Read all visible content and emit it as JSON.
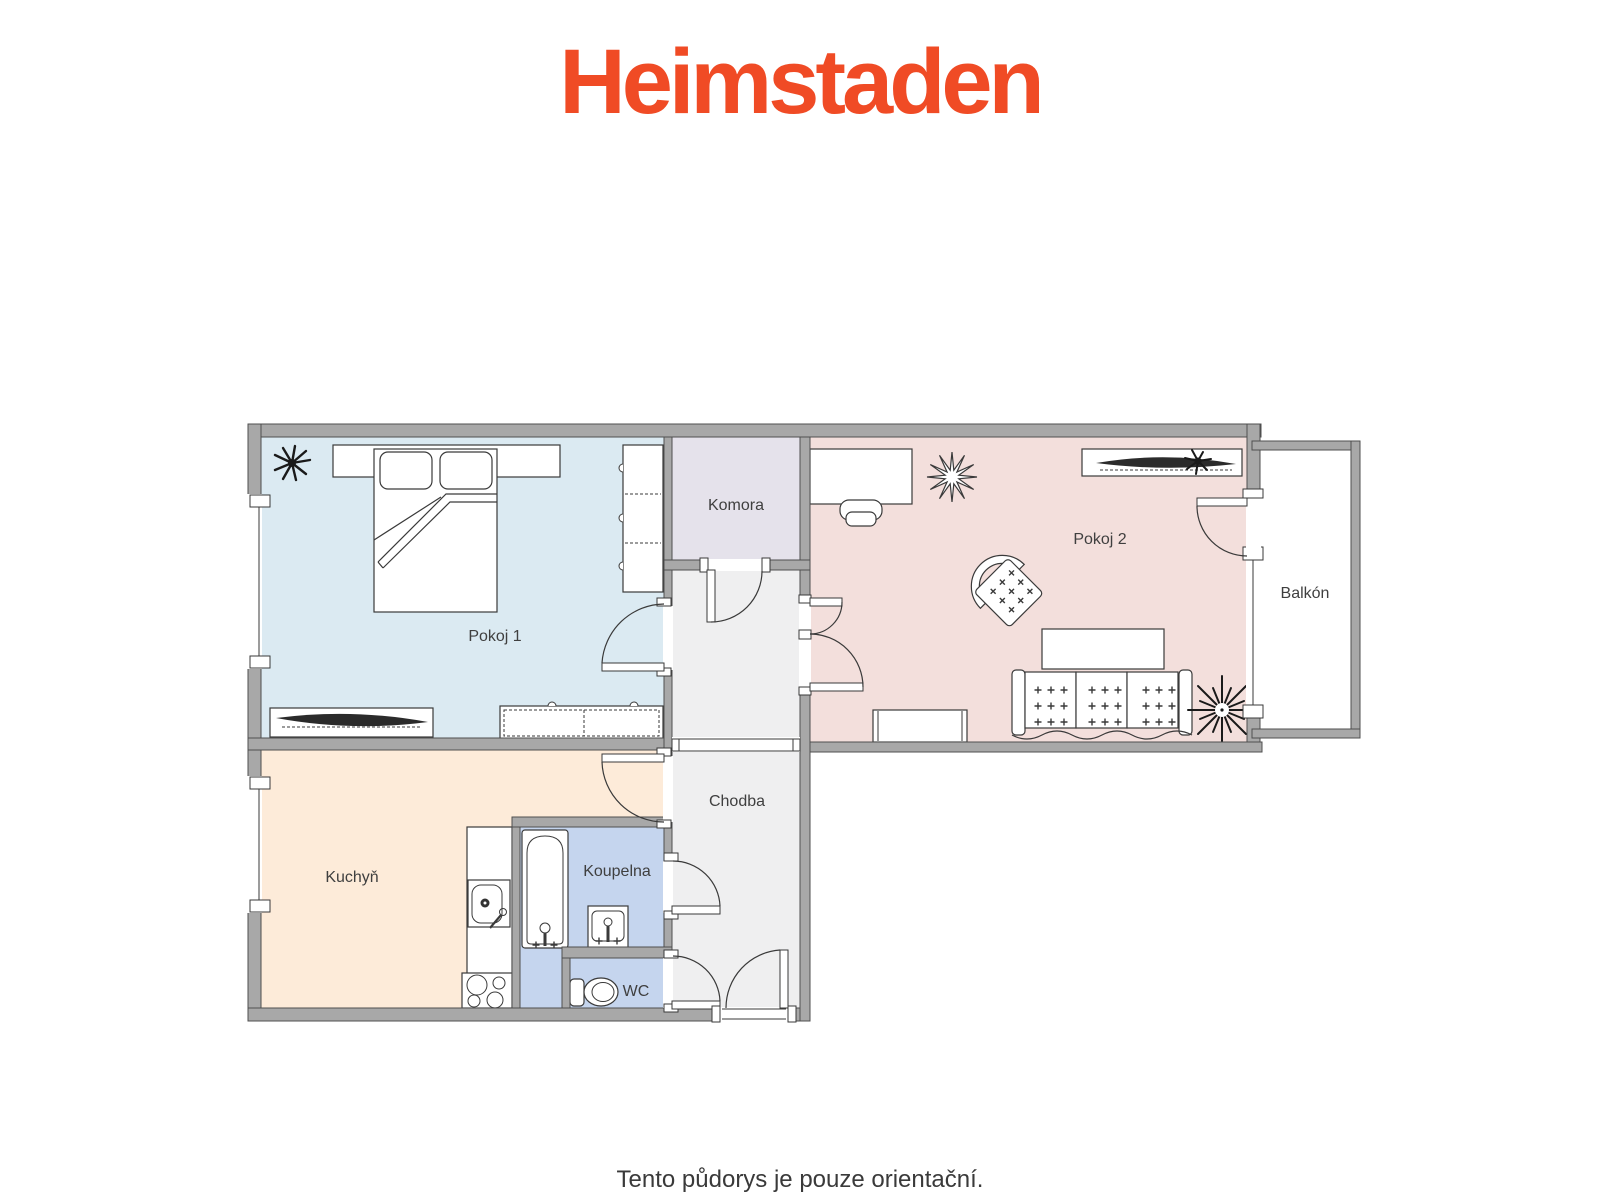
{
  "brand": {
    "logo_text": "Heimstaden",
    "logo_color": "#F04B25"
  },
  "footer": {
    "disclaimer": "Tento půdorys je pouze orientační."
  },
  "floorplan": {
    "wall_color": "#a8a8a8",
    "rooms": {
      "pokoj1": {
        "label": "Pokoj 1",
        "fill": "#dbeaf2"
      },
      "komora": {
        "label": "Komora",
        "fill": "#e5e2eb"
      },
      "pokoj2": {
        "label": "Pokoj 2",
        "fill": "#f3dfdc"
      },
      "balkon": {
        "label": "Balkón",
        "fill": "#ffffff"
      },
      "kuchyn": {
        "label": "Kuchyň",
        "fill": "#fdebd9"
      },
      "koupelna": {
        "label": "Koupelna",
        "fill": "#c5d5ee"
      },
      "wc": {
        "label": "WC",
        "fill": "#c5d5ee"
      },
      "chodba": {
        "label": "Chodba",
        "fill": "#efeff0"
      }
    }
  }
}
